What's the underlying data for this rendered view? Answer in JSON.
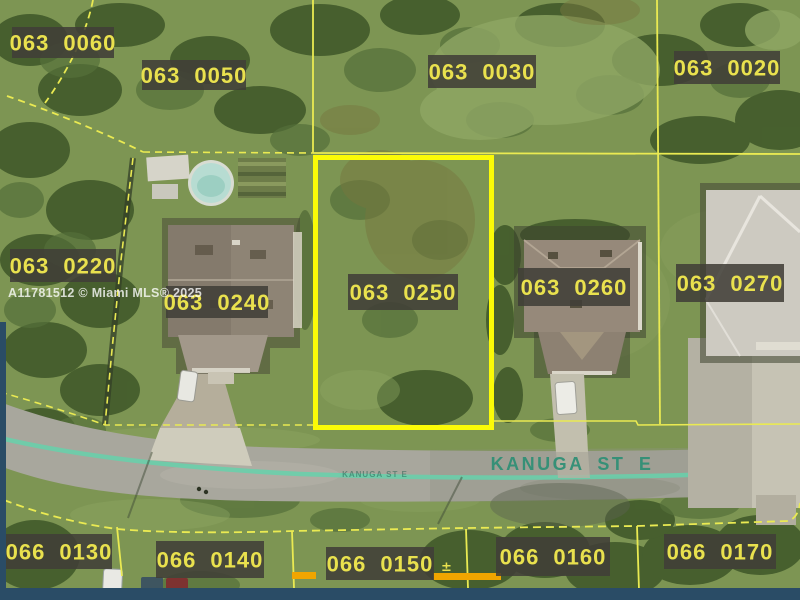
{
  "map": {
    "type": "aerial-parcel-map",
    "watermark": "A11781512 © Miami MLS® 2025",
    "street": {
      "name": "KANUGA ST E",
      "name_small": "KANUGA ST E"
    },
    "highlighted_parcel": "063 0250",
    "parcels": {
      "p063_0060": "063 0060",
      "p063_0050": "063 0050",
      "p063_0030": "063 0030",
      "p063_0020": "063 0020",
      "p063_0220": "063 0220",
      "p063_0240": "063 0240",
      "p063_0250": "063 0250",
      "p063_0260": "063 0260",
      "p063_0270": "063 0270",
      "p066_0130": "066 0130",
      "p066_0140": "066 0140",
      "p066_0150": "066 0150",
      "p066_0160": "066 0160",
      "p066_0170": "066 0170"
    },
    "survey_marker_glyph": "±",
    "colors": {
      "parcel_line": "#eaea52",
      "highlight_border": "#fbfb07",
      "label_text": "#e9e14e",
      "label_bg": "rgba(64,62,55,0.87)",
      "street_text": "#2d8f75",
      "street_stripe": "#66d1ab",
      "watermark_text": "#ffffff",
      "bottom_bar": "#2a4c66",
      "survey_marker": "#f0a500"
    }
  }
}
